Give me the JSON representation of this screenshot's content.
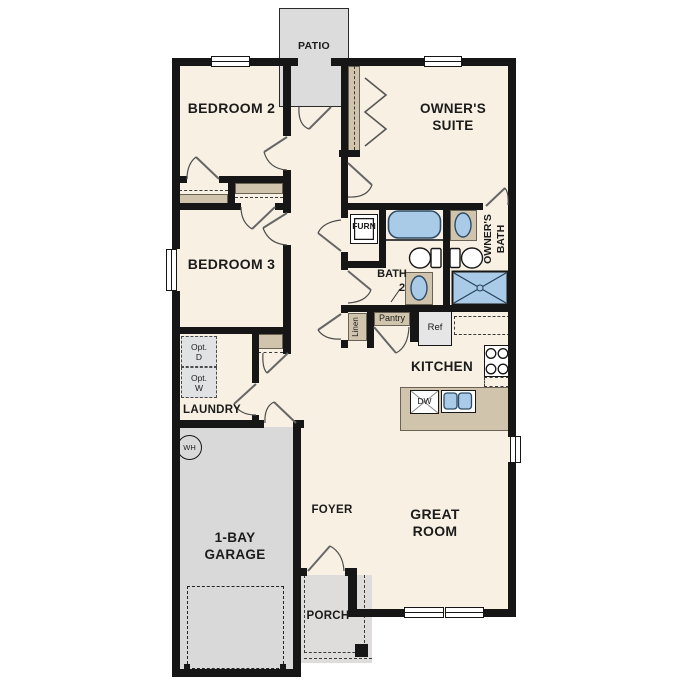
{
  "rooms": {
    "patio": {
      "label": "PATIO"
    },
    "bedroom2": {
      "label": "BEDROOM 2"
    },
    "owners_suite": {
      "l1": "OWNER'S",
      "l2": "SUITE"
    },
    "bedroom3": {
      "label": "BEDROOM 3"
    },
    "owners_bath": {
      "l1": "OWNER'S",
      "l2": "BATH"
    },
    "bath2": {
      "l1": "BATH",
      "l2": "2"
    },
    "kitchen": {
      "label": "KITCHEN"
    },
    "laundry": {
      "label": "LAUNDRY"
    },
    "foyer": {
      "label": "FOYER"
    },
    "great_room": {
      "l1": "GREAT",
      "l2": "ROOM"
    },
    "garage": {
      "l1": "1-BAY",
      "l2": "GARAGE"
    },
    "porch": {
      "label": "PORCH"
    }
  },
  "fixtures": {
    "furnace": "FURN",
    "linen": "Linen",
    "pantry": "Pantry",
    "refrigerator": "Ref",
    "dishwasher": "DW",
    "water_heater": "WH",
    "opt_dryer": {
      "l1": "Opt.",
      "l2": "D"
    },
    "opt_washer": {
      "l1": "Opt.",
      "l2": "W"
    }
  },
  "colors": {
    "wall": "#161616",
    "floor": "#f8f1e3",
    "concrete": "#dcdcdc",
    "casework_tan": "#d0c4ac",
    "fixture_blue": "#a9cbe8"
  }
}
